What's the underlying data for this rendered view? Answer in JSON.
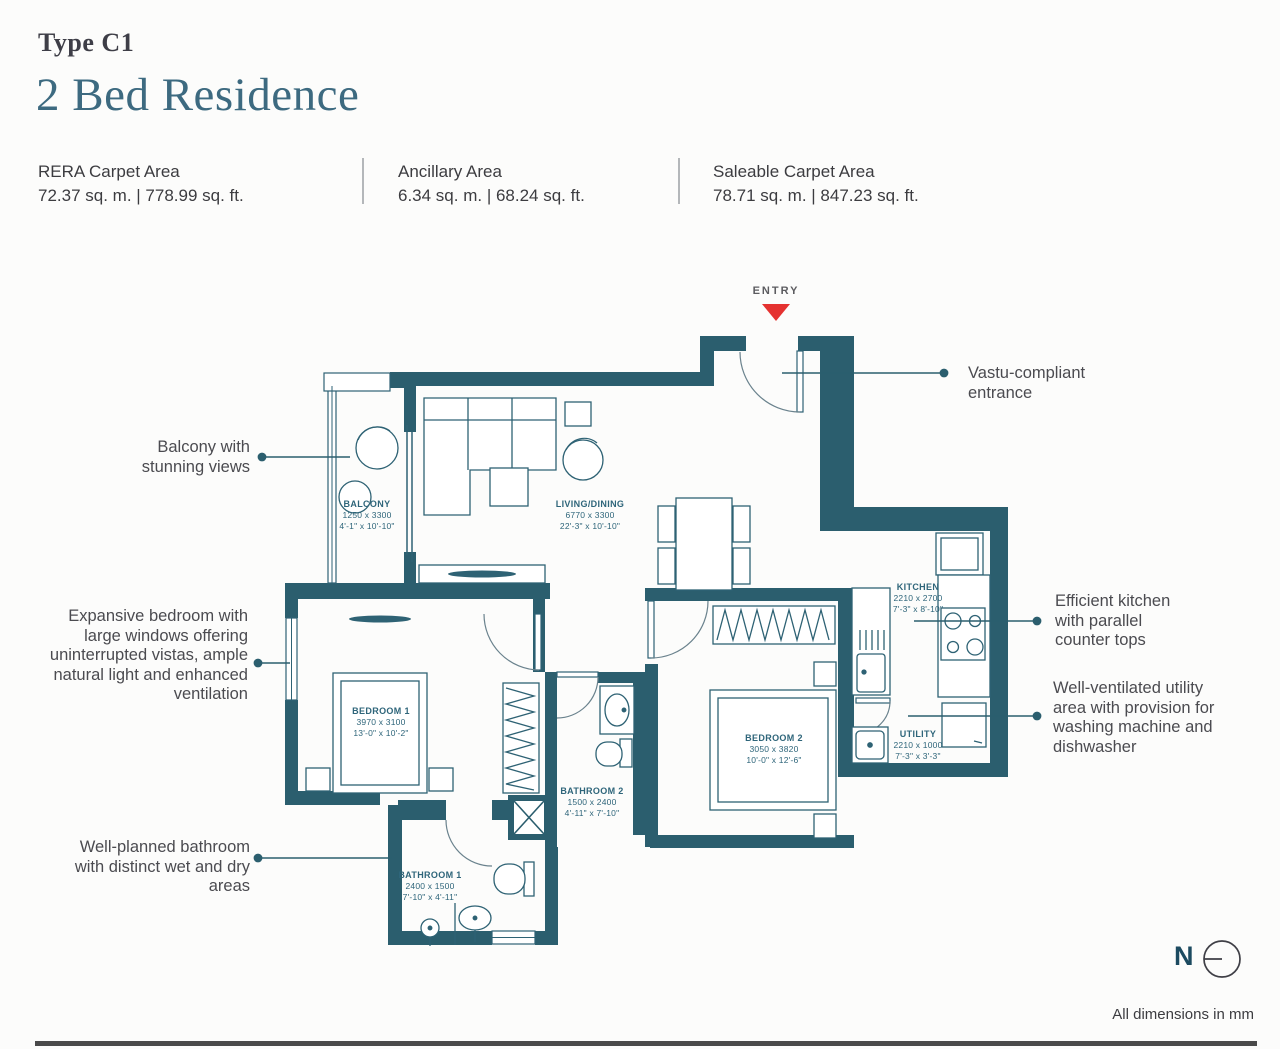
{
  "colors": {
    "wall": "#2b5e6e",
    "furniture_stroke": "#2e6274",
    "accent_red": "#e53230",
    "title_teal": "#3d6a80",
    "text_dark": "#3c3c40",
    "background": "#fcfcfb"
  },
  "header": {
    "type_label": "Type C1",
    "title": "2 Bed Residence"
  },
  "stats": [
    {
      "label": "RERA Carpet Area",
      "value": "72.37 sq. m. | 778.99 sq. ft."
    },
    {
      "label": "Ancillary Area",
      "value": "6.34 sq. m. | 68.24 sq. ft."
    },
    {
      "label": "Saleable Carpet Area",
      "value": "78.71 sq. m. | 847.23 sq. ft."
    }
  ],
  "plan": {
    "entry_label": "ENTRY",
    "rooms": [
      {
        "id": "balcony",
        "name": "BALCONY",
        "mm": "1250 x 3300",
        "ft": "4'-1\" x 10'-10\""
      },
      {
        "id": "living",
        "name": "LIVING/DINING",
        "mm": "6770 x 3300",
        "ft": "22'-3\" x 10'-10\""
      },
      {
        "id": "kitchen",
        "name": "KITCHEN",
        "mm": "2210 x 2700",
        "ft": "7'-3\" x 8'-10\""
      },
      {
        "id": "utility",
        "name": "UTILITY",
        "mm": "2210 x 1000",
        "ft": "7'-3\" x 3'-3\""
      },
      {
        "id": "bedroom1",
        "name": "BEDROOM 1",
        "mm": "3970 x 3100",
        "ft": "13'-0\" x 10'-2\""
      },
      {
        "id": "bedroom2",
        "name": "BEDROOM 2",
        "mm": "3050 x 3820",
        "ft": "10'-0\" x 12'-6\""
      },
      {
        "id": "bathroom1",
        "name": "BATHROOM 1",
        "mm": "2400 x 1500",
        "ft": "7'-10\" x 4'-11\""
      },
      {
        "id": "bathroom2",
        "name": "BATHROOM 2",
        "mm": "1500 x 2400",
        "ft": "4'-11\" x 7'-10\""
      }
    ]
  },
  "annotations": {
    "left": [
      {
        "id": "balcony-note",
        "text": "Balcony with stunning views"
      },
      {
        "id": "bedroom-note",
        "text": "Expansive bedroom with large windows offering uninterrupted vistas,  ample natural light and enhanced ventilation"
      },
      {
        "id": "bathroom-note",
        "text": "Well-planned bathroom with distinct wet and dry areas"
      }
    ],
    "right": [
      {
        "id": "entrance-note",
        "text": "Vastu-compliant entrance"
      },
      {
        "id": "kitchen-note",
        "text": "Efficient kitchen with parallel counter tops"
      },
      {
        "id": "utility-note",
        "text": "Well-ventilated utility area with provision for washing machine and dishwasher"
      }
    ]
  },
  "footer": {
    "north_label": "N",
    "dimensions_note": "All dimensions in mm"
  }
}
